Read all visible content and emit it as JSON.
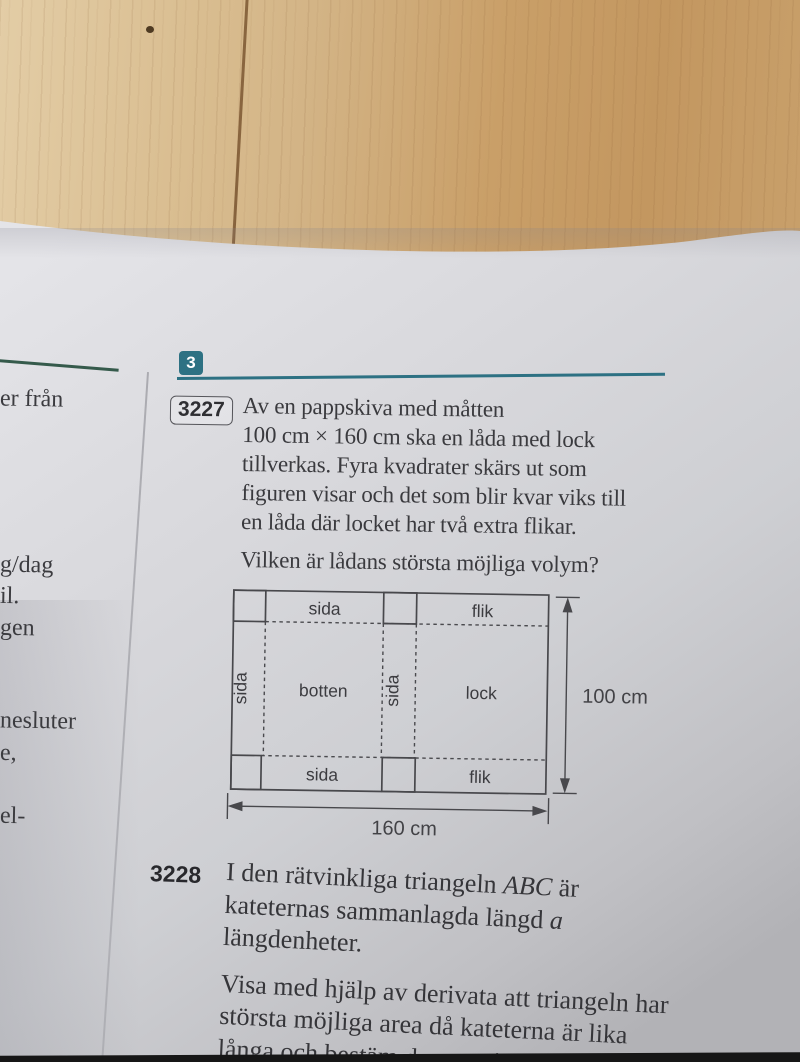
{
  "colors": {
    "accent_teal": "#2d7183",
    "left_rule_green": "#355a4b",
    "ink": "#3a3a3e"
  },
  "section": {
    "badge": "3"
  },
  "left_column": {
    "fragments": [
      "er från",
      "g/dag",
      "il.",
      "gen",
      "nesluter",
      "e,",
      "el-"
    ]
  },
  "problem_3227": {
    "number": "3227",
    "lines": [
      "Av en pappskiva med måtten",
      "100 cm × 160 cm ska en låda med lock",
      "tillverkas. Fyra kvadrater skärs ut som",
      "figuren visar och det som blir kvar viks till",
      "en låda där locket har två extra flikar."
    ],
    "question": "Vilken är lådans största möjliga volym?"
  },
  "diagram": {
    "side_top": "sida",
    "flap_top": "flik",
    "side_left": "sida",
    "bottom_label": "botten",
    "side_middle": "sida",
    "lid": "lock",
    "side_bottom": "sida",
    "flap_bottom": "flik",
    "height_dim": "100 cm",
    "width_dim": "160 cm"
  },
  "problem_3228": {
    "number": "3228",
    "line1_pre": "I den rätvinkliga triangeln ",
    "line1_italic": "ABC",
    "line1_post": " är",
    "line2_pre": "kateternas sammanlagda längd ",
    "line2_italic": "a",
    "line3": "längdenheter.",
    "para2": [
      "Visa med hjälp av derivata att triangeln har",
      "största möjliga area då kateterna är lika",
      "långa och bestäm den maximala"
    ]
  }
}
